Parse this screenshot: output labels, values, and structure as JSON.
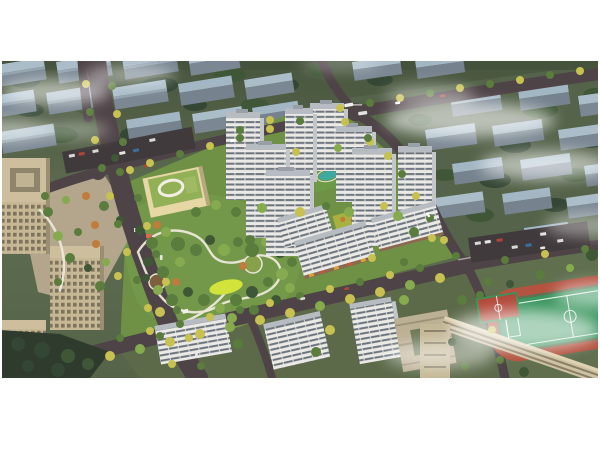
{
  "scene": {
    "kind": "aerial-architectural-rendering",
    "regions": [
      "background-cityscape",
      "fog-clouds",
      "arterial-roads",
      "tree-lined-boulevard",
      "central-park",
      "kindergarten-building",
      "residential-tower-cluster",
      "street-retail-slabs",
      "office-towers",
      "school-campus",
      "sports-field",
      "basketball-courts",
      "running-track",
      "parking-lots",
      "vehicles"
    ]
  },
  "colors": {
    "page_background": "#ffffff",
    "ground_top": "#4a5741",
    "ground_base": "#5c6a4e",
    "ground_school": "#60704f",
    "bg_building_roof": "#aabdc9",
    "bg_building_wall": "#7b8893",
    "road": "#4e4347",
    "road_dark": "#413a3d",
    "path": "#ece8da",
    "plaza": "#b3a68c",
    "park_green": "#74984a",
    "parcel_green": "#6e9145",
    "tree_darkest": "#344634",
    "tree_dark": "#3f5736",
    "tree_mid": "#5a7c3c",
    "tree_light": "#86ab4e",
    "tree_yellow": "#c7c151",
    "tree_orange": "#c07c3a",
    "lawn_bright": "#d2e43c",
    "tower_wall": "#ebeae6",
    "tower_window": "#6b747d",
    "tower_roof": "#b6bcc1",
    "tower_side": "#c3c7ca",
    "kindergarten_roof": "#92b055",
    "kindergarten_wall": "#e6d7a5",
    "office_tan": "#c4b692",
    "office_roof": "#cdbf9e",
    "office_court": "#8f856c",
    "pool_teal": "#3fa8a0",
    "roof_garden": "#a8b13f",
    "field_green": "#37945c",
    "track_red": "#b35340",
    "court_red": "#b24a3a",
    "line_white": "#ffffff",
    "fog": "#ffffff"
  }
}
